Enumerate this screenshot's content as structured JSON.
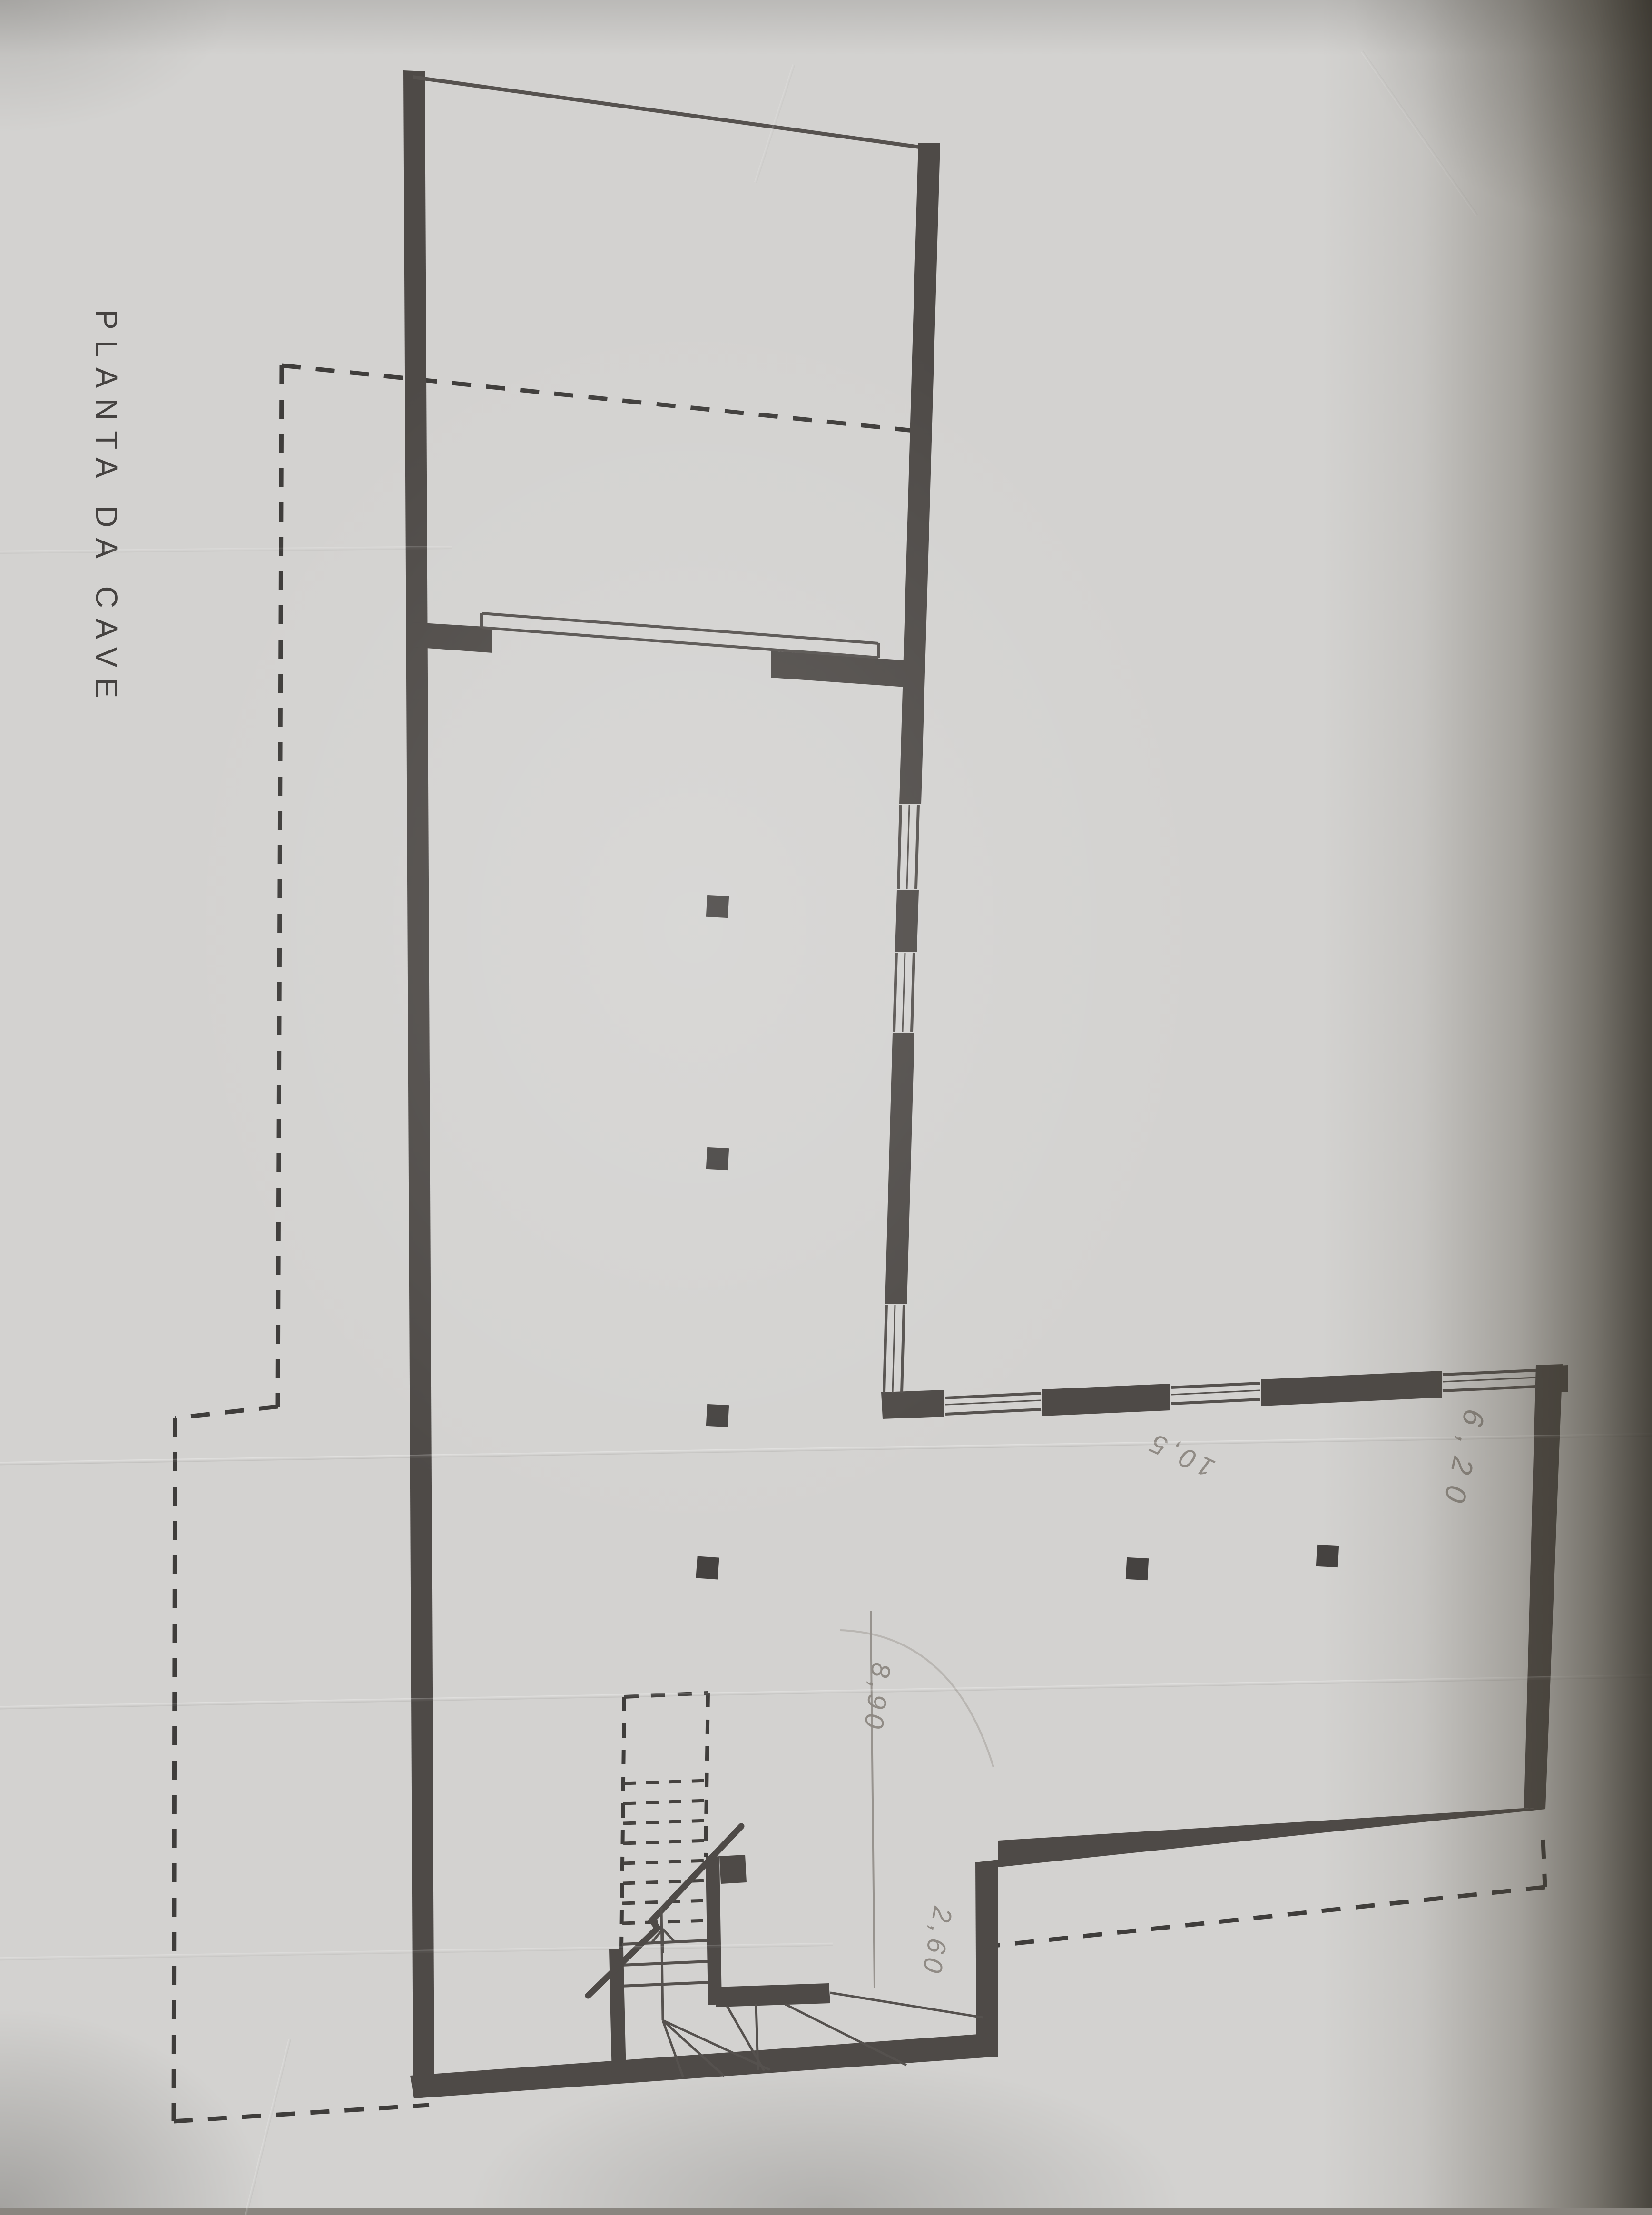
{
  "title": {
    "text": "PLANTA DA CAVE"
  },
  "dimension_labels": [
    {
      "id": "label_1",
      "value": "8,90"
    },
    {
      "id": "label_2",
      "value": "2,60"
    },
    {
      "id": "label_3",
      "value": "10,5"
    },
    {
      "id": "label_4",
      "value": "6,20"
    }
  ],
  "palette": {
    "paper": "#d3d2d0",
    "wall_ink": "#4e4a47",
    "thin_line_ink": "#55514e",
    "dashed_ink": "#3f3d3b",
    "pencil": "#8d8882",
    "photo_edge_shadow": "#4d4840"
  }
}
